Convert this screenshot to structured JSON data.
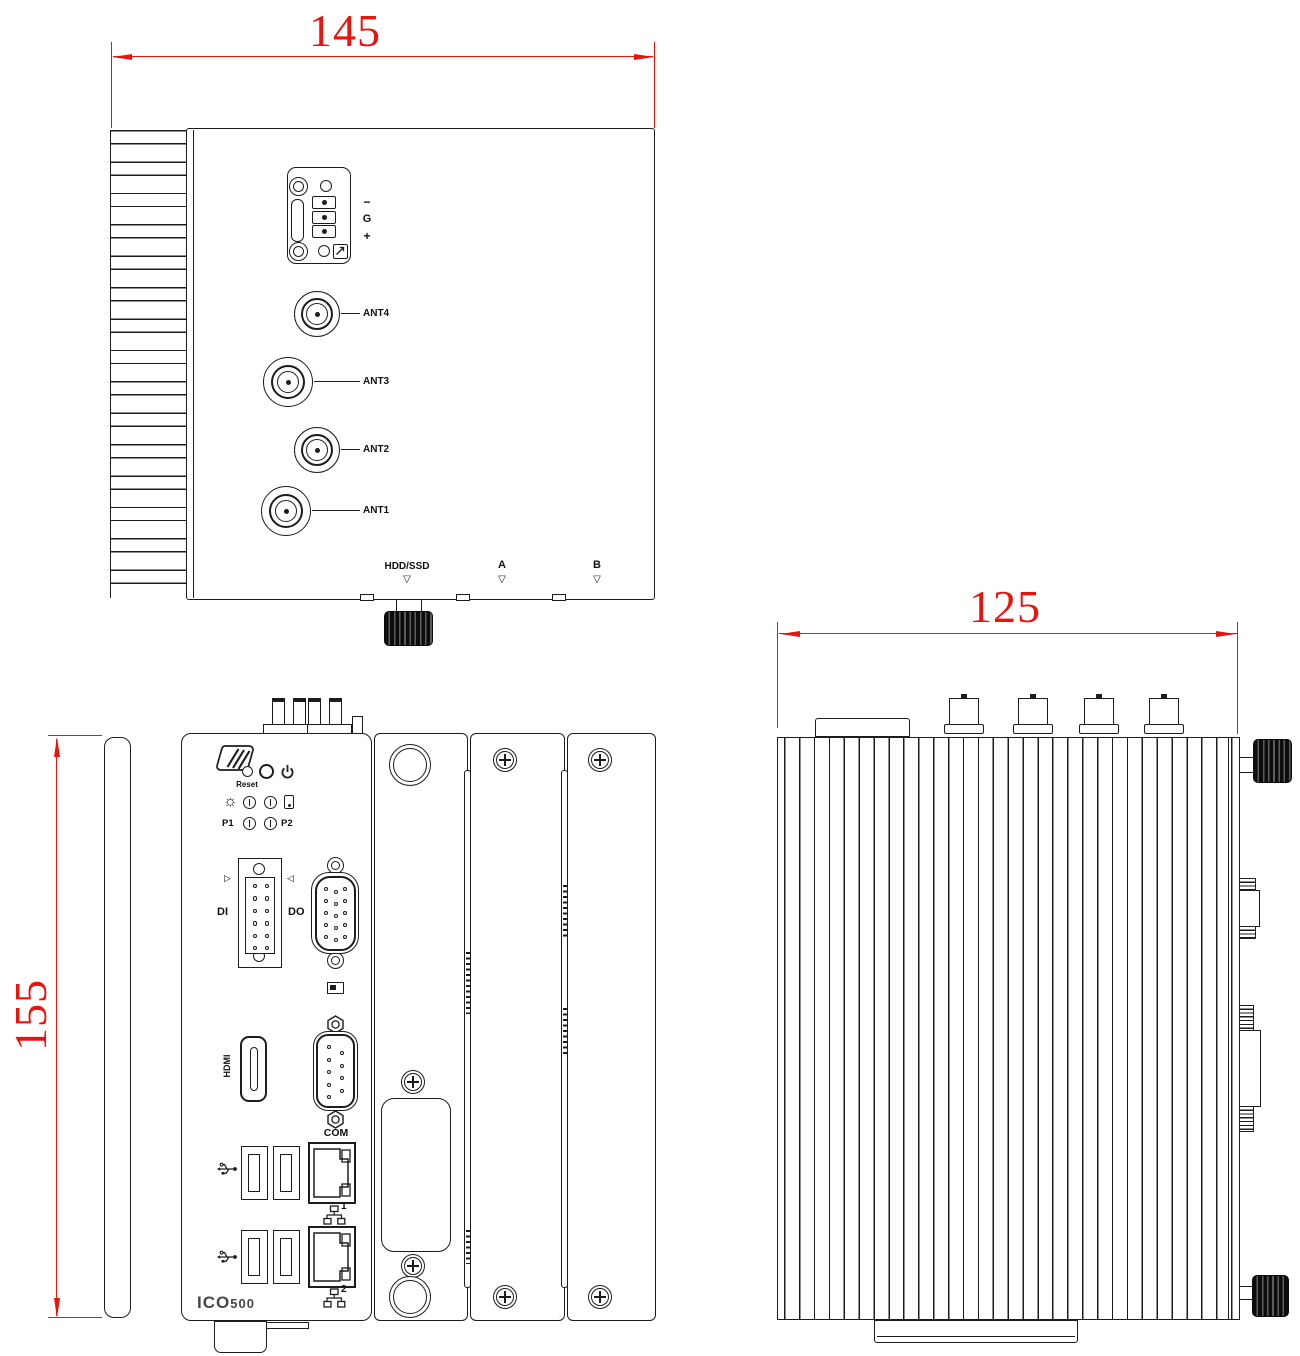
{
  "colors": {
    "dimension_red": "#e8150f",
    "line_ink": "#1d1d1d",
    "background": "#ffffff"
  },
  "dimensions": {
    "top_width": "145",
    "front_height": "155",
    "side_depth": "125"
  },
  "top_view": {
    "power_terminal_labels": [
      "−",
      "G",
      "+"
    ],
    "antenna_labels": [
      "ANT4",
      "ANT3",
      "ANT2",
      "ANT1"
    ],
    "edge_markers": [
      {
        "label": "HDD/SSD",
        "glyph": "▽"
      },
      {
        "label": "A",
        "glyph": "▽"
      },
      {
        "label": "B",
        "glyph": "▽"
      }
    ]
  },
  "front_view": {
    "reset_label": "Reset",
    "p1_label": "P1",
    "p2_label": "P2",
    "di_label": "DI",
    "do_label": "DO",
    "di_glyph": "▷",
    "do_glyph": "◁",
    "lamp_glyph": "☼",
    "hdmi_label": "HDMI",
    "com_label": "COM",
    "lan_ports": [
      "1",
      "2"
    ],
    "model_prefix": "ICO",
    "model_suffix": "500"
  }
}
